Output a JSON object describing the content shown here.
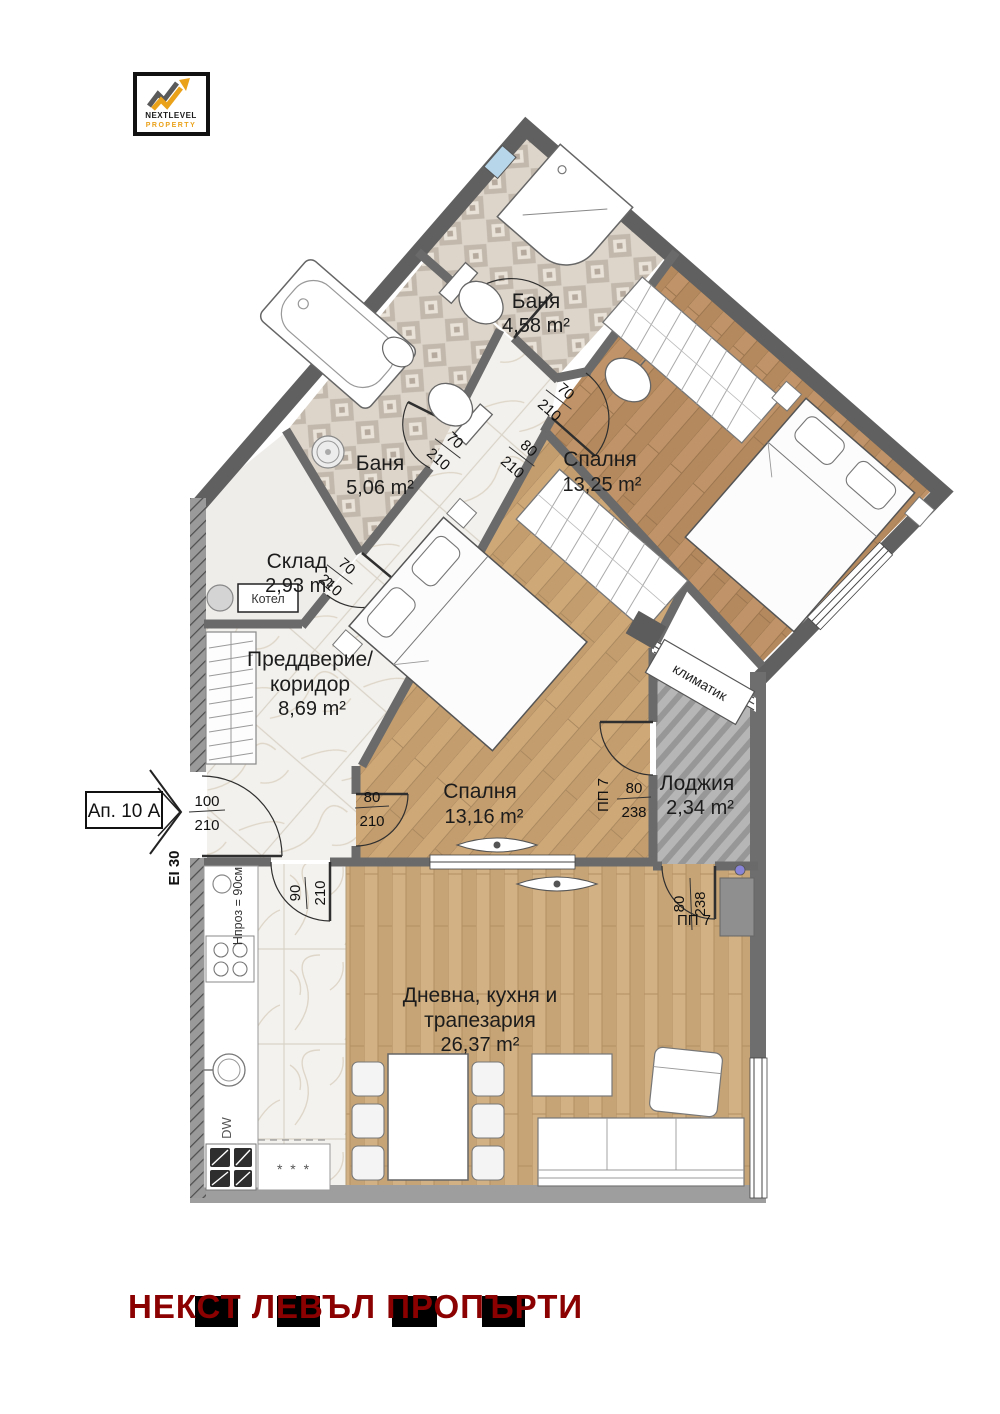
{
  "logo": {
    "brand_line1": "NEXTLEVEL",
    "brand_line2": "PROPERTY"
  },
  "entrance": {
    "apartment_label": "Ап. 10 А",
    "fire_rating": "EI 30",
    "door_width": "100",
    "door_height": "210"
  },
  "rooms": {
    "bath1": {
      "name": "Баня",
      "area": "4,58 m²",
      "door_width": "70",
      "door_height": "210"
    },
    "bath2": {
      "name": "Баня",
      "area": "5,06 m²",
      "door_width": "70",
      "door_height": "210"
    },
    "storage": {
      "name": "Склад",
      "area": "2,93 m²",
      "door_width": "70",
      "door_height": "210",
      "boiler_label": "Котел"
    },
    "bedroom1": {
      "name": "Спалня",
      "area": "13,25 m²",
      "door_width": "80",
      "door_height": "210"
    },
    "bedroom2": {
      "name": "Спалня",
      "area": "13,16 m²",
      "door_width": "80",
      "door_height": "210",
      "balcony_door_label": "ПП 7",
      "balcony_door_width": "80",
      "balcony_door_height": "238"
    },
    "hall": {
      "name_line1": "Преддверие/",
      "name_line2": "коридор",
      "area": "8,69 m²"
    },
    "loggia": {
      "name": "Лоджия",
      "area": "2,34 m²",
      "ac_label": "климатик"
    },
    "living": {
      "name_line1": "Дневна, кухня и",
      "name_line2": "трапезария",
      "area": "26,37 m²",
      "door_width": "90",
      "door_height": "210",
      "balcony_door_label": "ПП 7",
      "balcony_door_width": "80",
      "balcony_door_height": "238",
      "worktop_note": "Hпроз = 90см",
      "dishwasher_label": "DW",
      "fridge_label": "* * *"
    }
  },
  "footer": {
    "brand_text": "НЕКСТ ЛЕВЪЛ ПРОПЪРТИ"
  },
  "colors": {
    "wall_dark": "#606060",
    "wall_light": "#9e9e9e",
    "footer_red": "#8B0000",
    "accent_yellow": "#EAA21B"
  }
}
